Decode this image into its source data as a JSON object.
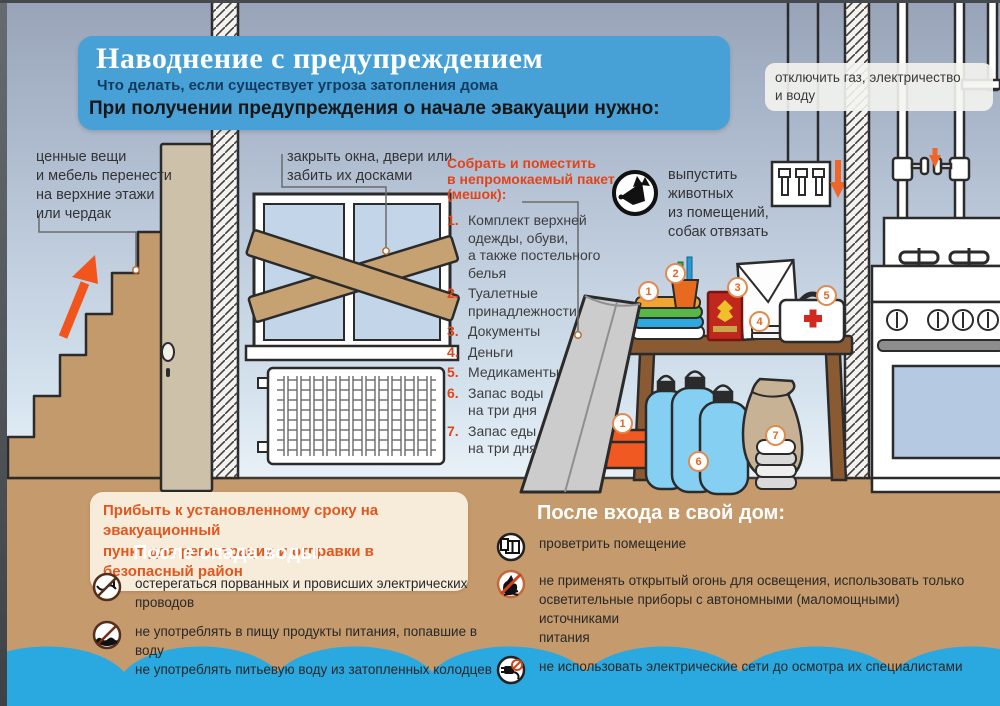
{
  "title": {
    "heading": "Наводнение с предупреждением",
    "subtitle": "Что делать, если существует угроза затопления дома",
    "instruction": "При получении предупреждения о начале эвакуации нужно:"
  },
  "labels": {
    "utilities": "отключить газ, электричество\nи воду",
    "valuables": "ценные вещи\nи мебель перенести\nна верхние этажи\nили чердак",
    "windows": "закрыть окна, двери или\nзабить их досками",
    "animals": "выпустить\nживотных\nиз помещений,\nсобак отвязать"
  },
  "pack_list": {
    "heading": "Собрать и поместить\nв непромокаемый пакет\n(мешок):",
    "items": [
      {
        "num": "1.",
        "text": "Комплект верхней\nодежды, обуви,\nа также постельного\nбелья"
      },
      {
        "num": "2.",
        "text": "Туалетные\nпринадлежности"
      },
      {
        "num": "3.",
        "text": "Документы"
      },
      {
        "num": "4.",
        "text": "Деньги"
      },
      {
        "num": "5.",
        "text": "Медикаменты"
      },
      {
        "num": "6.",
        "text": "Запас воды\nна три дня"
      },
      {
        "num": "7.",
        "text": "Запас еды\nна три дня"
      }
    ]
  },
  "badges": {
    "clothes": "1",
    "toiletries": "2",
    "documents": "3",
    "money": "4",
    "medicine": "5",
    "shoebox": "1",
    "water": "6",
    "food": "7"
  },
  "evacuation_note": "Прибыть к установленному сроку на эвакуационный\nпункт для регистрации и отправки в безопасный район",
  "after_water": {
    "heading": "После спада воды:",
    "items": [
      "остерегаться порванных и провисших электрических проводов",
      "не употреблять в пищу продукты питания, попавшие в воду\nне употреблять питьевую воду из затопленных колодцев"
    ]
  },
  "after_home": {
    "heading": "После входа в свой дом:",
    "items": [
      "проветрить помещение",
      "не применять открытый огонь для освещения, использовать только\nосветительные приборы с автономными (маломощными) источниками\nпитания",
      "не использовать электрические сети до осмотра их специалистами"
    ]
  },
  "colors": {
    "header_bg": "#47a1d7",
    "accent_red": "#e2441a",
    "floor": "#c59a6c",
    "water": "#29a9e0",
    "wood": "#c49f70",
    "note_bg": "#f7ecd9"
  }
}
